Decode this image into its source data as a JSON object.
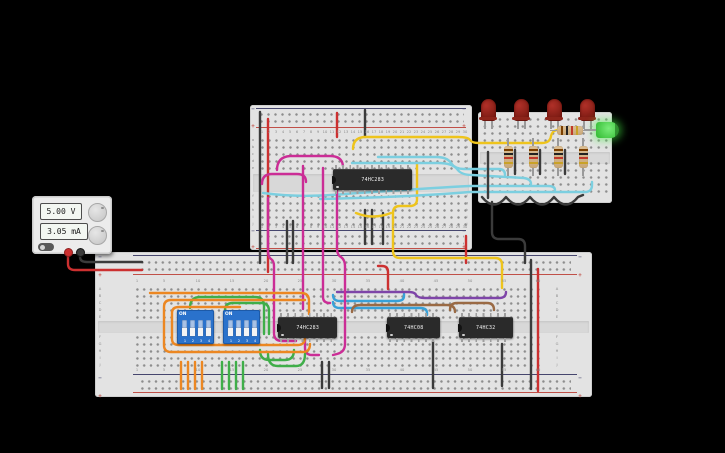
{
  "app": {
    "background": "#000000"
  },
  "power_supply": {
    "voltage": "5.00 V",
    "current": "3.05 mA"
  },
  "ics": [
    {
      "id": "ic-top-adder",
      "label": "74HC283"
    },
    {
      "id": "ic-bottom-adder",
      "label": "74HC283"
    },
    {
      "id": "ic-and-gate",
      "label": "74HC08"
    },
    {
      "id": "ic-or-gate",
      "label": "74HC32"
    }
  ],
  "dip_switches": [
    {
      "label": "ON",
      "pins": [
        "1",
        "2",
        "3",
        "4"
      ],
      "states": [
        "down",
        "down",
        "down",
        "down"
      ]
    },
    {
      "label": "ON",
      "pins": [
        "1",
        "2",
        "3",
        "4"
      ],
      "states": [
        "down",
        "down",
        "down",
        "down"
      ]
    }
  ],
  "leds": [
    {
      "color": "red",
      "state": "off"
    },
    {
      "color": "red",
      "state": "off"
    },
    {
      "color": "red",
      "state": "off"
    },
    {
      "color": "red",
      "state": "off"
    },
    {
      "color": "green",
      "state": "on"
    }
  ],
  "resistors": {
    "vertical_count": 4,
    "horizontal_count": 1,
    "bands": [
      "brown",
      "black",
      "red",
      "gold"
    ]
  },
  "boards": {
    "upper": {
      "columns_from": 1,
      "columns_to": 30,
      "column_step": 1,
      "row_letters": [
        "a",
        "b",
        "c",
        "d",
        "e",
        "f",
        "g",
        "h",
        "i",
        "j"
      ]
    },
    "lower": {
      "columns_from": 1,
      "columns_to": 60,
      "column_step": 5,
      "row_letters": [
        "A",
        "B",
        "C",
        "D",
        "E",
        "F",
        "G",
        "H",
        "I",
        "J"
      ]
    },
    "rail_markers": {
      "plus": "+",
      "minus": "−"
    }
  },
  "wire_colors": {
    "black": "#3b3b3b",
    "red": "#cc3030",
    "yellow": "#eec41c",
    "cyan": "#7ccfe0",
    "blue": "#38a1d8",
    "purple": "#7e45a8",
    "brown": "#9a6a44",
    "magenta": "#cb2d96",
    "green": "#3fae49",
    "orange": "#ec8722"
  },
  "wires": [
    {
      "name": "psu-black-to-rail",
      "color": "#3b3b3b",
      "d": "M80,251 L80,257 Q80,262 87,262 L142,262"
    },
    {
      "name": "psu-red-to-rail",
      "color": "#cc3030",
      "d": "M68,251 L68,264 Q68,270 75,270 L142,270"
    },
    {
      "name": "rail-jumper-black",
      "color": "#3b3b3b",
      "d": "M260,112 L260,263"
    },
    {
      "name": "rail-jumper-red",
      "color": "#cc3030",
      "d": "M268,119 L268,272"
    },
    {
      "name": "upper-top-black-stub",
      "color": "#3b3b3b",
      "d": "M365,110 L365,137"
    },
    {
      "name": "upper-top-red-stub",
      "color": "#cc3030",
      "d": "M337,113 L337,137"
    },
    {
      "name": "upper-bottom-black-stub-1",
      "color": "#3b3b3b",
      "d": "M365,210 L365,244"
    },
    {
      "name": "upper-bottom-black-stub-2",
      "color": "#3b3b3b",
      "d": "M372,210 L372,244"
    },
    {
      "name": "upper-bottom-black-stub-3",
      "color": "#3b3b3b",
      "d": "M383,213 L383,244"
    },
    {
      "name": "gap-black-1",
      "color": "#3b3b3b",
      "d": "M287,221 L287,263"
    },
    {
      "name": "gap-black-2",
      "color": "#3b3b3b",
      "d": "M293,221 L293,263"
    },
    {
      "name": "gap-red",
      "color": "#cc3030",
      "d": "M466,236 L466,263"
    },
    {
      "name": "yellow-to-green-led",
      "color": "#eec41c",
      "d": "M353,149 Q353,138 364,137 L458,137 Q468,137 470,140 Q472,143 479,143 L542,143 Q550,143 551,136 Q552,131 557,130"
    },
    {
      "name": "yellow-arc-under-ic",
      "color": "#eec41c",
      "d": "M356,213 Q373,220 391,213"
    },
    {
      "name": "yellow-to-lower-rail",
      "color": "#eec41c",
      "d": "M417,163 L417,199 Q417,206 410,206 L400,206 Q393,206 393,213 L393,251 Q393,258 400,258 L495,258 Q502,258 502,265 L502,288"
    },
    {
      "name": "cyan-sum-1",
      "color": "#7ccfe0",
      "d": "M378,157 L436,157 Q447,157 451,163 Q455,169 464,169 L499,169 Q505,169 505,175"
    },
    {
      "name": "cyan-sum-2",
      "color": "#7ccfe0",
      "d": "M352,163 L438,163 Q452,163 457,169 Q461,175 472,175 L524,178 Q531,179 531,184"
    },
    {
      "name": "cyan-sum-3",
      "color": "#7ccfe0",
      "d": "M263,193 Q300,198 345,194 Q430,188 470,186 L548,186 Q555,186 555,190"
    },
    {
      "name": "cyan-sum-4",
      "color": "#7ccfe0",
      "d": "M320,199 Q410,197 470,192 L585,192 Q592,192 592,185 L592,182"
    },
    {
      "name": "blue-bus-1",
      "color": "#38a1d8",
      "d": "M333,295 Q333,301 340,301 L397,301 Q404,301 404,296 L404,294"
    },
    {
      "name": "blue-bus-2",
      "color": "#38a1d8",
      "d": "M333,302 Q333,308 340,308 L420,308 Q427,308 427,313 L427,315"
    },
    {
      "name": "purple-bus",
      "color": "#7e45a8",
      "d": "M337,292 L408,292 Q415,292 416,295 Q418,298 425,298 L499,298 Q506,298 506,292"
    },
    {
      "name": "brown-link-1",
      "color": "#9a6a44",
      "d": "M352,312 Q352,305 360,305 L447,305 Q455,305 455,312"
    },
    {
      "name": "brown-link-2",
      "color": "#9a6a44",
      "d": "M450,310 Q450,303 457,303 L487,303 Q494,303 494,310"
    },
    {
      "name": "magenta-arc-1",
      "color": "#cb2d96",
      "d": "M277,170 Q277,157 290,156 L330,156 Q342,156 343,166"
    },
    {
      "name": "magenta-arc-2",
      "color": "#cb2d96",
      "d": "M262,184 Q262,174 272,174 L297,174 Q306,174 306,182"
    },
    {
      "name": "magenta-cross-1",
      "color": "#cb2d96",
      "d": "M268,198 L268,250 Q268,257 271,259 Q274,261 274,266 L274,333 Q274,341 282,341 L296,341"
    },
    {
      "name": "magenta-cross-2",
      "color": "#cb2d96",
      "d": "M303,166 L303,309"
    },
    {
      "name": "magenta-cross-3",
      "color": "#cb2d96",
      "d": "M323,168 L323,297 Q323,303 330,303"
    },
    {
      "name": "magenta-cross-4",
      "color": "#cb2d96",
      "d": "M337,172 L337,248 Q337,255 341,257 Q345,260 345,266 L345,344 Q345,352 337,354 L333,355"
    },
    {
      "name": "magenta-hook",
      "color": "#cb2d96",
      "d": "M305,339 L305,348 Q305,355 312,355 L319,355"
    },
    {
      "name": "green-arc-1",
      "color": "#3fae49",
      "d": "M190,308 Q190,297 200,297 L255,297 Q264,297 264,306 L264,334"
    },
    {
      "name": "green-arc-2",
      "color": "#3fae49",
      "d": "M225,310 Q225,303 233,303 L261,303 Q269,303 269,311 L269,334"
    },
    {
      "name": "green-arc-3",
      "color": "#3fae49",
      "d": "M260,350 Q260,360 269,360 L285,360 Q294,360 294,350"
    },
    {
      "name": "green-arc-4",
      "color": "#3fae49",
      "d": "M268,354 Q268,366 278,366 L296,366 Q305,366 305,354"
    },
    {
      "name": "green-stub-1",
      "color": "#3fae49",
      "d": "M222,362 L222,389"
    },
    {
      "name": "green-stub-2",
      "color": "#3fae49",
      "d": "M229,362 L229,389"
    },
    {
      "name": "green-stub-3",
      "color": "#3fae49",
      "d": "M236,362 L236,389"
    },
    {
      "name": "green-stub-4",
      "color": "#3fae49",
      "d": "M243,362 L243,389"
    },
    {
      "name": "orange-top",
      "color": "#ec8722",
      "d": "M150,293 L301,293 Q309,293 309,301 L309,314"
    },
    {
      "name": "orange-loop-outer",
      "color": "#ec8722",
      "d": "M305,300 L171,300 Q164,300 164,307 L164,345 Q164,352 171,352 L303,352 Q310,352 310,344"
    },
    {
      "name": "orange-loop-inner",
      "color": "#ec8722",
      "d": "M240,307 L179,307 Q172,307 172,313 L172,339 Q172,345 179,345 L298,345 Q305,345 305,337"
    },
    {
      "name": "orange-stub-1",
      "color": "#ec8722",
      "d": "M181,362 L181,389"
    },
    {
      "name": "orange-stub-2",
      "color": "#ec8722",
      "d": "M188,362 L188,389"
    },
    {
      "name": "orange-stub-3",
      "color": "#ec8722",
      "d": "M195,362 L195,389"
    },
    {
      "name": "orange-stub-4",
      "color": "#ec8722",
      "d": "M202,362 L202,389"
    },
    {
      "name": "small-black-vert",
      "color": "#3b3b3b",
      "d": "M488,152 L488,198"
    },
    {
      "name": "small-black-scallop",
      "color": "#3b3b3b",
      "d": "M482,197 Q494,212 506,197 Q518,212 530,197 Q542,212 554,197 Q566,212 578,197 L583,195"
    },
    {
      "name": "small-cathode-stub-1",
      "color": "#3b3b3b",
      "d": "M515,150 L515,174"
    },
    {
      "name": "small-cathode-stub-2",
      "color": "#3b3b3b",
      "d": "M540,150 L540,174"
    },
    {
      "name": "small-cathode-stub-3",
      "color": "#3b3b3b",
      "d": "M565,150 L565,174"
    },
    {
      "name": "small-to-lower-black",
      "color": "#3b3b3b",
      "d": "M492,202 L492,232 Q492,239 499,239 L518,239 Q525,239 525,246 L525,263"
    },
    {
      "name": "lower-long-black",
      "color": "#3b3b3b",
      "d": "M531,260 L531,389"
    },
    {
      "name": "lower-long-red",
      "color": "#cc3030",
      "d": "M538,269 L538,391"
    },
    {
      "name": "lower-red-stub",
      "color": "#cc3030",
      "d": "M378,266 L382,266 Q388,266 388,272 L388,289"
    },
    {
      "name": "lower-bottom-black-1",
      "color": "#3b3b3b",
      "d": "M433,341 L433,388"
    },
    {
      "name": "lower-bottom-black-2",
      "color": "#3b3b3b",
      "d": "M502,344 L502,386"
    },
    {
      "name": "lower-bottom-black-3",
      "color": "#3b3b3b",
      "d": "M322,362 L322,388"
    },
    {
      "name": "lower-bottom-black-4",
      "color": "#3b3b3b",
      "d": "M329,362 L329,388"
    }
  ]
}
